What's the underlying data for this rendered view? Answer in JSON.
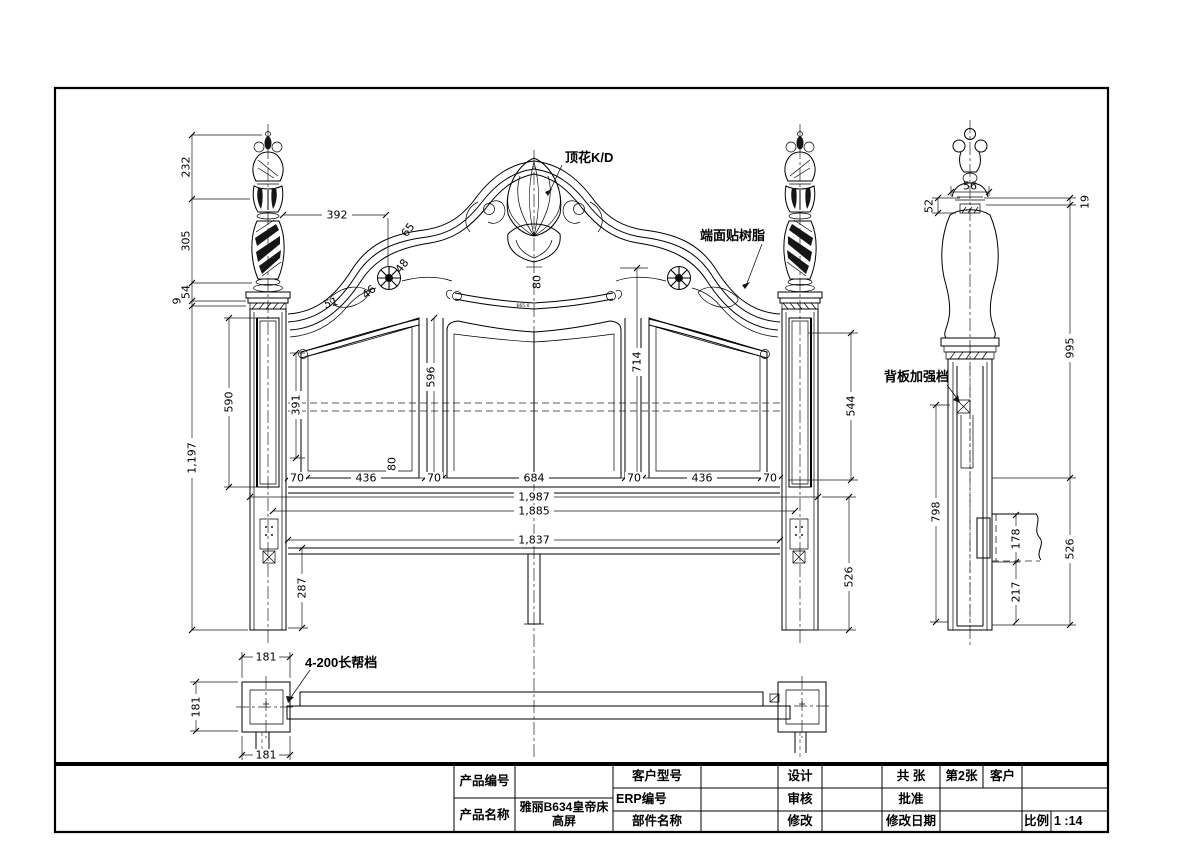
{
  "labels": {
    "top_flower": "顶花K/D",
    "end_face_resin": "端面贴树脂",
    "back_panel_reinforce": "背板加强档",
    "long_side_rail": "4-200长帮档"
  },
  "front": {
    "finial_chain": [
      "232",
      "305",
      "54",
      "9"
    ],
    "total_height": "1,197",
    "crest_width": "392",
    "curve_dims": [
      "65",
      "48",
      "46",
      "51"
    ],
    "crest_drop": "80",
    "center_top_mark": "665.0",
    "post_panel_height": "590",
    "left_panel_inner_height": "391",
    "center_panel_height": "596",
    "center_stile_height": "714",
    "right_post_panel_height": "544",
    "bottom_chain": [
      "70",
      "436",
      "80",
      "70",
      "684",
      "70",
      "436",
      "70"
    ],
    "overall_widths": [
      "1,987",
      "1,885",
      "1,837"
    ],
    "leg_height": "287",
    "post_below_height": "526"
  },
  "side": {
    "finial_neck_width": "56",
    "finial_cap": "52",
    "top_offset": "19",
    "upper_height": "995",
    "back_height": "798",
    "lower_height": "526",
    "rail_height": "178",
    "rail_bottom": "217"
  },
  "plan": {
    "post_width": "181",
    "post_depth": "181",
    "tenon": "181"
  },
  "title_block": {
    "product_no_label": "产品编号",
    "product_name_label": "产品名称",
    "product_name_value": "雅丽B634皇帝床高屏",
    "customer_model_label": "客户型号",
    "erp_no_label": "ERP编号",
    "part_name_label": "部件名称",
    "design_label": "设计",
    "audit_label": "审核",
    "modify_label": "修改",
    "total_sheet_label": "共 张",
    "sheet_no": "第2张",
    "customer_label": "客户",
    "approve_label": "批准",
    "modify_date_label": "修改日期",
    "scale_label": "比例",
    "scale_value": "1 :14"
  }
}
